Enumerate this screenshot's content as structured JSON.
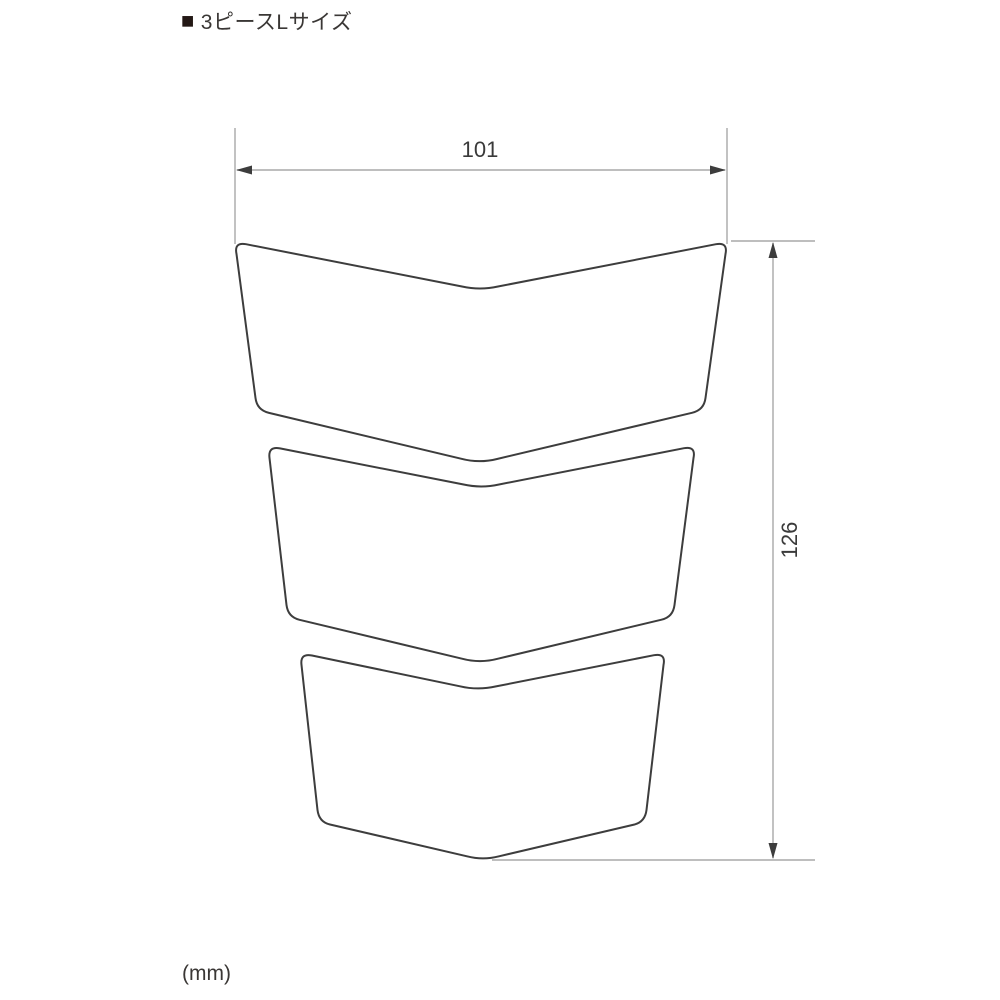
{
  "title": {
    "bullet": "■",
    "text": "3ピースLサイズ"
  },
  "drawing": {
    "type": "technical-dimension-diagram",
    "subject": "3-piece tank pad outline drawing, size L",
    "pieces": [
      "top-piece",
      "middle-piece",
      "bottom-piece"
    ],
    "dimensions": {
      "width": {
        "value": "101",
        "orientation": "horizontal"
      },
      "height": {
        "value": "126",
        "orientation": "vertical"
      }
    },
    "unit_label": "(mm)"
  },
  "colors": {
    "background": "#ffffff",
    "outline": "#3d3d3d",
    "dimension_line": "#a8a8a8",
    "dimension_text": "#3a3a3a",
    "title_text": "#3a3735",
    "title_bullet": "#231815"
  }
}
